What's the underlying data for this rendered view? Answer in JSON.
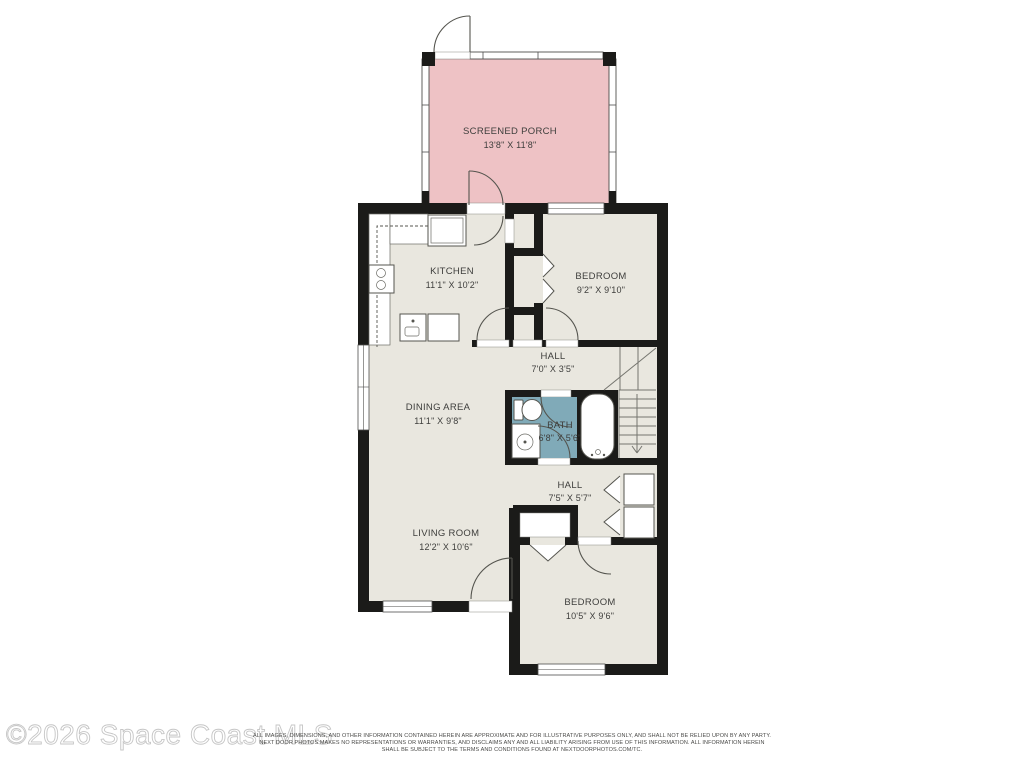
{
  "plan": {
    "rooms": [
      {
        "name": "SCREENED PORCH",
        "dims": "13'8\" X 11'8\""
      },
      {
        "name": "KITCHEN",
        "dims": "11'1\" X 10'2\""
      },
      {
        "name": "BEDROOM",
        "dims": "9'2\" X 9'10\""
      },
      {
        "name": "HALL",
        "dims": "7'0\" X 3'5\""
      },
      {
        "name": "DINING AREA",
        "dims": "11'1\" X 9'8\""
      },
      {
        "name": "BATH",
        "dims": "6'8\" X 5'6\""
      },
      {
        "name": "HALL",
        "dims": "7'5\" X 5'7\""
      },
      {
        "name": "LIVING ROOM",
        "dims": "12'2\" X 10'6\""
      },
      {
        "name": "BEDROOM",
        "dims": "10'5\" X 9'6\""
      }
    ]
  },
  "watermark": "©2026 Space Coast MLS",
  "disclaimer": {
    "line1": "ALL IMAGES, DIMENSIONS, AND OTHER INFORMATION CONTAINED HEREIN ARE APPROXIMATE AND FOR ILLUSTRATIVE PURPOSES ONLY, AND SHALL NOT BE RELIED UPON BY ANY PARTY.",
    "line2": "NEXT DOOR PHOTOS MAKES NO REPRESENTATIONS OR WARRANTIES, AND DISCLAIMS ANY AND ALL LIABILITY ARISING FROM USE OF THIS INFORMATION. ALL INFORMATION HEREIN",
    "line3": "SHALL BE SUBJECT TO THE TERMS AND CONDITIONS FOUND AT NEXTDOORPHOTOS.COM/TC."
  },
  "colors": {
    "porch": "#eec2c5",
    "bath": "#80aab8",
    "floor": "#e9e7df",
    "wall": "#1b1b19",
    "background": "#ffffff"
  }
}
